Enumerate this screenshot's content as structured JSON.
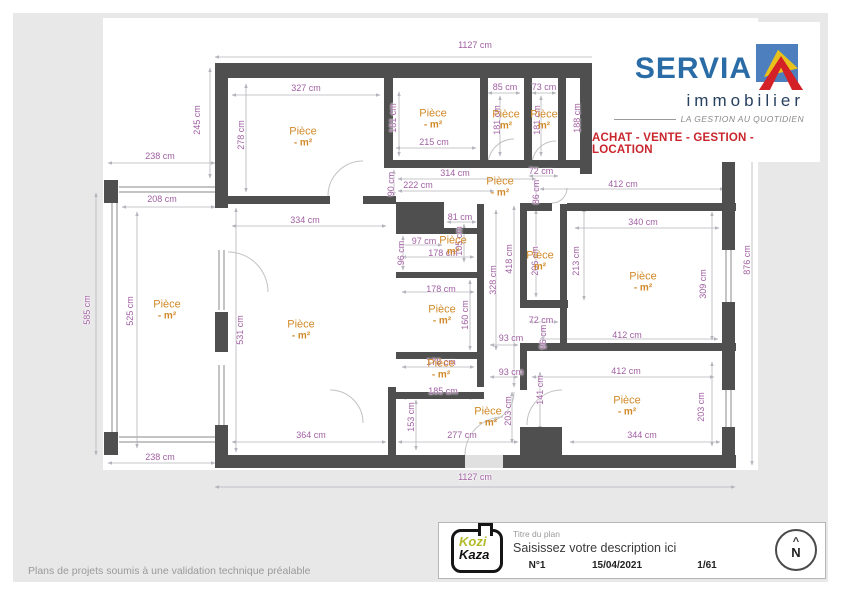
{
  "colors": {
    "wall": "#4f4f4f",
    "dimension_text": "#a160a3",
    "room_text": "#d18a2a",
    "brand_blue": "#2a6ca5",
    "brand_navy": "#27405f",
    "brand_red": "#c9252c",
    "canvas": "#e8e8e8"
  },
  "logo": {
    "brand": "SERVIA",
    "sub": "immobilier",
    "tagline": "LA GESTION AU QUOTIDIEN",
    "banner": "ACHAT - VENTE - GESTION - LOCATION"
  },
  "footer": {
    "kozi": "Kozi",
    "kaza": "Kaza",
    "title_label": "Titre du plan",
    "description_placeholder": "Saisissez votre description ici",
    "number": "N°1",
    "date": "15/04/2021",
    "page": "1/61",
    "compass_letter": "N",
    "compass_chevron": "^"
  },
  "disclaimer": "Plans de projets soumis à une validation technique préalable",
  "plan": {
    "unit": "cm",
    "dimensions": [
      {
        "t": "1127 cm",
        "x": 475,
        "y": 45,
        "r": 0
      },
      {
        "t": "245 cm",
        "x": 197,
        "y": 120,
        "r": 1
      },
      {
        "t": "238 cm",
        "x": 160,
        "y": 156,
        "r": 0
      },
      {
        "t": "208 cm",
        "x": 162,
        "y": 199,
        "r": 0
      },
      {
        "t": "327 cm",
        "x": 306,
        "y": 88,
        "r": 0
      },
      {
        "t": "278 cm",
        "x": 241,
        "y": 135,
        "r": 1
      },
      {
        "t": "181 cm",
        "x": 393,
        "y": 118,
        "r": 1
      },
      {
        "t": "215 cm",
        "x": 434,
        "y": 142,
        "r": 0
      },
      {
        "t": "85 cm",
        "x": 505,
        "y": 87,
        "r": 0
      },
      {
        "t": "181 cm",
        "x": 497,
        "y": 120,
        "r": 1
      },
      {
        "t": "73 cm",
        "x": 544,
        "y": 87,
        "r": 0
      },
      {
        "t": "181 cm",
        "x": 537,
        "y": 120,
        "r": 1
      },
      {
        "t": "188 cm",
        "x": 577,
        "y": 118,
        "r": 1
      },
      {
        "t": "314 cm",
        "x": 455,
        "y": 173,
        "r": 0
      },
      {
        "t": "222 cm",
        "x": 418,
        "y": 185,
        "r": 0
      },
      {
        "t": "90 cm",
        "x": 391,
        "y": 184,
        "r": 1
      },
      {
        "t": "412 cm",
        "x": 623,
        "y": 184,
        "r": 0
      },
      {
        "t": "334 cm",
        "x": 305,
        "y": 220,
        "r": 0
      },
      {
        "t": "340 cm",
        "x": 643,
        "y": 222,
        "r": 0
      },
      {
        "t": "531 cm",
        "x": 240,
        "y": 330,
        "r": 1
      },
      {
        "t": "525 cm",
        "x": 130,
        "y": 311,
        "r": 1
      },
      {
        "t": "585 cm",
        "x": 87,
        "y": 310,
        "r": 1
      },
      {
        "t": "876 cm",
        "x": 747,
        "y": 260,
        "r": 1
      },
      {
        "t": "309 cm",
        "x": 703,
        "y": 284,
        "r": 1
      },
      {
        "t": "213 cm",
        "x": 576,
        "y": 261,
        "r": 1
      },
      {
        "t": "206 cm",
        "x": 535,
        "y": 261,
        "r": 1
      },
      {
        "t": "418 cm",
        "x": 509,
        "y": 259,
        "r": 1
      },
      {
        "t": "328 cm",
        "x": 493,
        "y": 280,
        "r": 1
      },
      {
        "t": "81 cm",
        "x": 460,
        "y": 217,
        "r": 0
      },
      {
        "t": "97 cm",
        "x": 424,
        "y": 241,
        "r": 0
      },
      {
        "t": "105 cm",
        "x": 459,
        "y": 241,
        "r": 1
      },
      {
        "t": "96 cm",
        "x": 401,
        "y": 253,
        "r": 1
      },
      {
        "t": "178 cm",
        "x": 443,
        "y": 253,
        "r": 0
      },
      {
        "t": "178 cm",
        "x": 441,
        "y": 289,
        "r": 0
      },
      {
        "t": "160 cm",
        "x": 465,
        "y": 315,
        "r": 1
      },
      {
        "t": "93 cm",
        "x": 511,
        "y": 338,
        "r": 0
      },
      {
        "t": "93 cm",
        "x": 511,
        "y": 372,
        "r": 0
      },
      {
        "t": "178 cm",
        "x": 441,
        "y": 362,
        "r": 0
      },
      {
        "t": "72 cm",
        "x": 541,
        "y": 171,
        "r": 0
      },
      {
        "t": "86 cm",
        "x": 536,
        "y": 192,
        "r": 1
      },
      {
        "t": "72 cm",
        "x": 541,
        "y": 320,
        "r": 0
      },
      {
        "t": "96 cm",
        "x": 543,
        "y": 337,
        "r": 1
      },
      {
        "t": "412 cm",
        "x": 627,
        "y": 335,
        "r": 0
      },
      {
        "t": "412 cm",
        "x": 626,
        "y": 371,
        "r": 0
      },
      {
        "t": "141 cm",
        "x": 540,
        "y": 390,
        "r": 1
      },
      {
        "t": "203 cm",
        "x": 701,
        "y": 407,
        "r": 1
      },
      {
        "t": "203 cm",
        "x": 508,
        "y": 411,
        "r": 1
      },
      {
        "t": "344 cm",
        "x": 642,
        "y": 435,
        "r": 0
      },
      {
        "t": "364 cm",
        "x": 311,
        "y": 435,
        "r": 0
      },
      {
        "t": "277 cm",
        "x": 462,
        "y": 435,
        "r": 0
      },
      {
        "t": "185 cm",
        "x": 443,
        "y": 391,
        "r": 0
      },
      {
        "t": "153 cm",
        "x": 411,
        "y": 417,
        "r": 1
      },
      {
        "t": "238 cm",
        "x": 160,
        "y": 457,
        "r": 0
      },
      {
        "t": "1127 cm",
        "x": 475,
        "y": 477,
        "r": 0
      }
    ],
    "rooms": [
      {
        "n": "Pièce",
        "a": "- m²",
        "x": 303,
        "y": 137
      },
      {
        "n": "Pièce",
        "a": "- m²",
        "x": 433,
        "y": 119
      },
      {
        "n": "Pièce",
        "a": "m²",
        "x": 506,
        "y": 120
      },
      {
        "n": "Pièce",
        "a": "m²",
        "x": 544,
        "y": 120
      },
      {
        "n": "Pièce",
        "a": "- m²",
        "x": 500,
        "y": 187
      },
      {
        "n": "Pièce",
        "a": "m²",
        "x": 453,
        "y": 246
      },
      {
        "n": "Pièce",
        "a": "- m²",
        "x": 442,
        "y": 315
      },
      {
        "n": "Pièce",
        "a": "- m²",
        "x": 441,
        "y": 369
      },
      {
        "n": "Pièce",
        "a": "m²",
        "x": 540,
        "y": 261
      },
      {
        "n": "Pièce",
        "a": "- m²",
        "x": 643,
        "y": 282
      },
      {
        "n": "Pièce",
        "a": "- m²",
        "x": 627,
        "y": 406
      },
      {
        "n": "Pièce",
        "a": "- m²",
        "x": 488,
        "y": 417
      },
      {
        "n": "Pièce",
        "a": "- m²",
        "x": 167,
        "y": 310
      },
      {
        "n": "Pièce",
        "a": "- m²",
        "x": 301,
        "y": 330
      }
    ]
  }
}
